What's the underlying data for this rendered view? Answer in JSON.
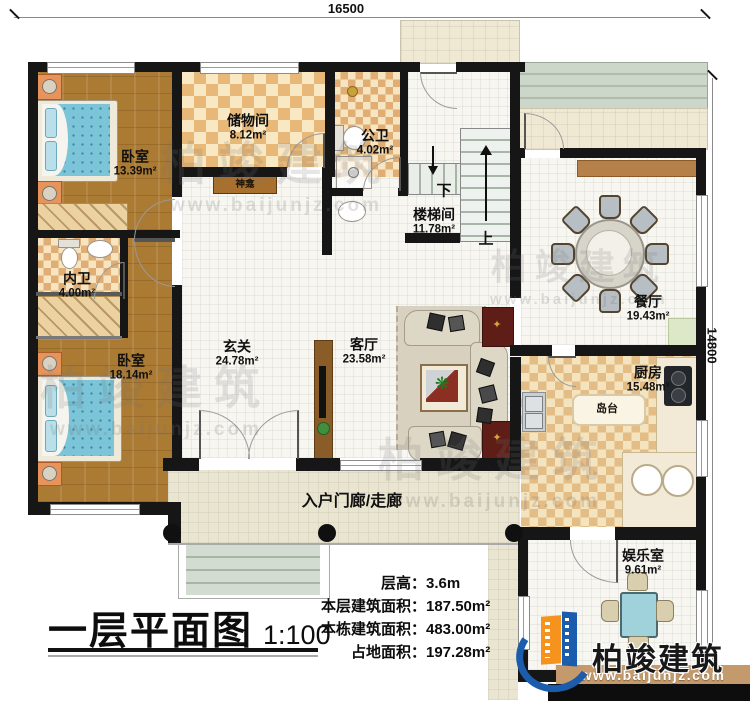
{
  "title_block": {
    "title": "一层平面图",
    "scale": "1:100"
  },
  "dimensions": {
    "top": "16500",
    "right": "14800"
  },
  "stats": [
    {
      "label": "层高：",
      "value": "3.6m"
    },
    {
      "label": "本层建筑面积：",
      "value": "187.50m²"
    },
    {
      "label": "本栋建筑面积：",
      "value": "483.00m²"
    },
    {
      "label": "占地面积：",
      "value": "197.28m²"
    }
  ],
  "rooms": [
    {
      "id": "bedroom-1",
      "name": "卧室",
      "area": "13.39m²"
    },
    {
      "id": "storage",
      "name": "储物间",
      "area": "8.12m²"
    },
    {
      "id": "public-bath",
      "name": "公卫",
      "area": "4.02m²"
    },
    {
      "id": "stair-hall",
      "name": "楼梯间",
      "area": "11.78m²"
    },
    {
      "id": "dining",
      "name": "餐厅",
      "area": "19.43m²"
    },
    {
      "id": "ensuite-bath",
      "name": "内卫",
      "area": "4.00m²"
    },
    {
      "id": "bedroom-2",
      "name": "卧室",
      "area": "18.14m²"
    },
    {
      "id": "foyer",
      "name": "玄关",
      "area": "24.78m²"
    },
    {
      "id": "living",
      "name": "客厅",
      "area": "23.58m²"
    },
    {
      "id": "kitchen",
      "name": "厨房",
      "area": "15.48m²"
    },
    {
      "id": "recreation",
      "name": "娱乐室",
      "area": "9.61m²"
    }
  ],
  "annotations": {
    "porch": "入户门廊/走廊",
    "island": "岛台",
    "shrine": "神龛",
    "stairs_down": "下",
    "stairs_up": "上"
  },
  "brand": {
    "name": "柏竣建筑",
    "url": "www.baijunjz.com"
  },
  "colors": {
    "wall": "#161616",
    "wood_floor": "#ab7a33",
    "tile_tan": "#e7b877",
    "bed_blue": "#7cc4d8",
    "br_blue": "#1c5cad",
    "brand_orange": "#f6921e",
    "brand_band": "#c49a6c"
  }
}
